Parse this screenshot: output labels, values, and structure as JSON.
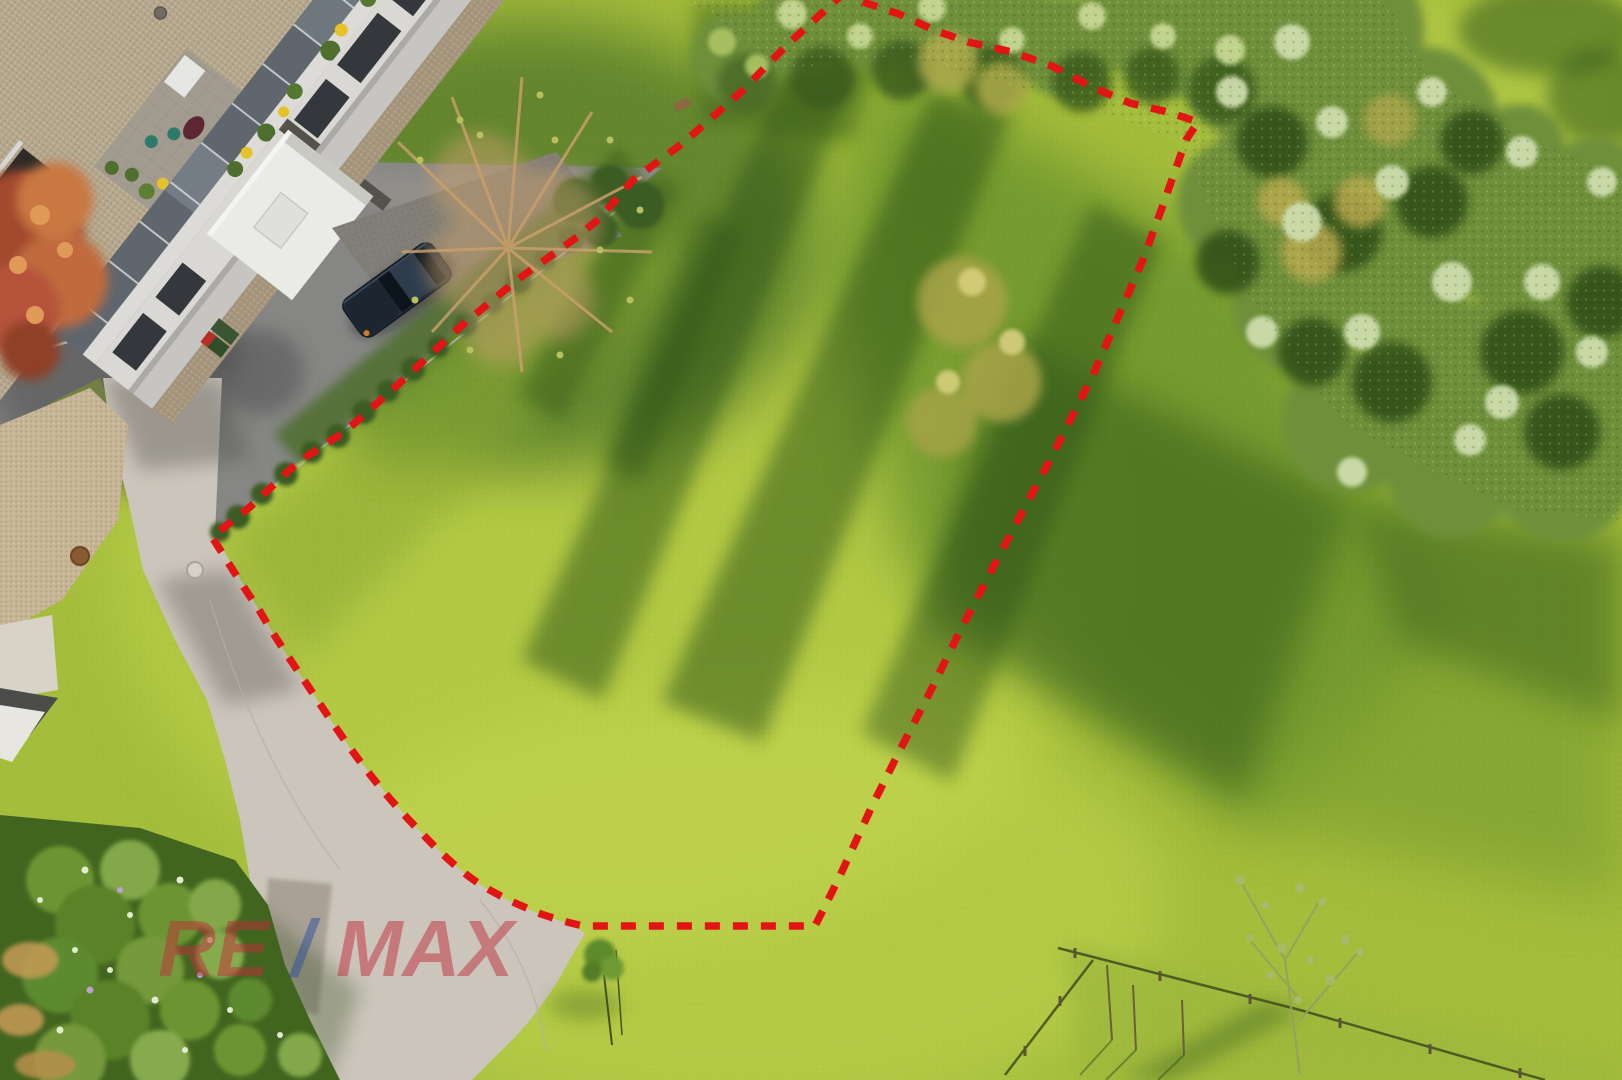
{
  "image": {
    "kind": "aerial drone photograph of a building plot for sale",
    "width_px": 1622,
    "height_px": 1080
  },
  "watermark": {
    "part_re": "RE",
    "part_slash": "/",
    "part_max": "MAX",
    "red": "#c22f3a",
    "blue": "#2d4f9e",
    "opacity": 0.5
  },
  "boundary": {
    "color": "#e31414",
    "stroke_width": 7.5,
    "dash_pattern": "15 13"
  },
  "palette": {
    "grass_base": "#a4bd3b",
    "grass_bright": "#c2d54d",
    "grass_shadow": "#2c5117",
    "canopy_green": "#6f8f3a",
    "asphalt": "#868684",
    "concrete_road": "#cbc5bb",
    "roof_gravel": "#b4a78d",
    "facade_white": "#dad8d4",
    "car_navy": "#222d3a",
    "bare_tree_tan": "#c7a06d",
    "garden_green": "#41651f"
  }
}
